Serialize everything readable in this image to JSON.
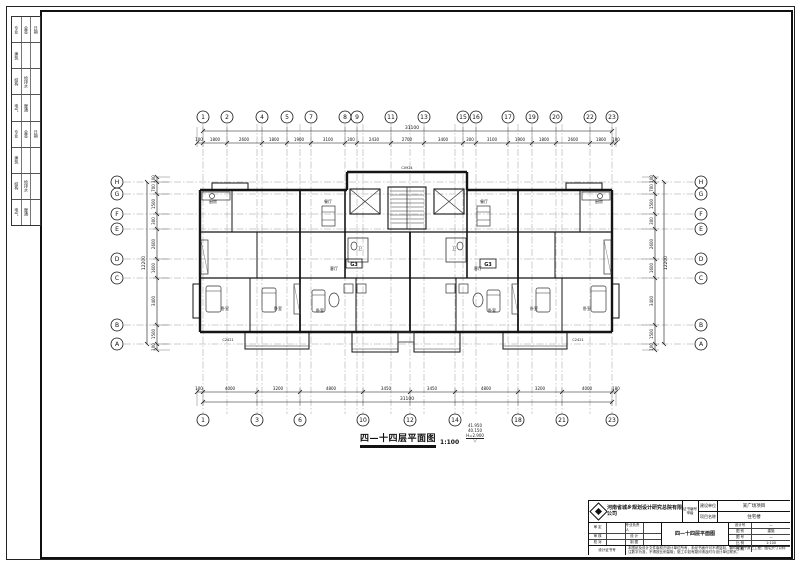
{
  "sheet": {
    "caption": "四—十四层平面图",
    "scale": "1:100",
    "elevations": [
      "41.950",
      "40.150",
      "H=2.900"
    ],
    "level_symbol": "▽"
  },
  "drawing": {
    "grid_top": {
      "y": 117,
      "items": [
        [
          "1",
          203
        ],
        [
          "2",
          227
        ],
        [
          "4",
          262
        ],
        [
          "5",
          287
        ],
        [
          "7",
          311
        ],
        [
          "8",
          345
        ],
        [
          "9",
          357
        ],
        [
          "11",
          391
        ],
        [
          "13",
          424
        ],
        [
          "15",
          463
        ],
        [
          "16",
          476
        ],
        [
          "17",
          508
        ],
        [
          "19",
          532
        ],
        [
          "20",
          556
        ],
        [
          "22",
          590
        ],
        [
          "23",
          612
        ]
      ]
    },
    "grid_bottom": {
      "y": 420,
      "items": [
        [
          "1",
          203
        ],
        [
          "3",
          257
        ],
        [
          "6",
          300
        ],
        [
          "10",
          363
        ],
        [
          "12",
          410
        ],
        [
          "14",
          455
        ],
        [
          "18",
          518
        ],
        [
          "21",
          562
        ],
        [
          "23",
          612
        ]
      ]
    },
    "grid_left": {
      "x": 117,
      "items": [
        [
          "H",
          182
        ],
        [
          "G",
          194
        ],
        [
          "F",
          214
        ],
        [
          "E",
          229
        ],
        [
          "D",
          259
        ],
        [
          "C",
          278
        ],
        [
          "B",
          325
        ],
        [
          "A",
          344
        ]
      ]
    },
    "grid_right": {
      "x": 701,
      "items": [
        [
          "H",
          182
        ],
        [
          "G",
          194
        ],
        [
          "F",
          214
        ],
        [
          "E",
          229
        ],
        [
          "D",
          259
        ],
        [
          "C",
          278
        ],
        [
          "B",
          325
        ],
        [
          "A",
          344
        ]
      ]
    },
    "dims_top": {
      "labels": [
        [
          "100",
          199
        ],
        [
          "1800",
          215
        ],
        [
          "2600",
          244
        ],
        [
          "1800",
          274
        ],
        [
          "1900",
          299
        ],
        [
          "3100",
          328
        ],
        [
          "300",
          351
        ],
        [
          "2430",
          374
        ],
        [
          "2700",
          407
        ],
        [
          "3400",
          443
        ],
        [
          "300",
          470
        ],
        [
          "3100",
          492
        ],
        [
          "1900",
          520
        ],
        [
          "1800",
          544
        ],
        [
          "2600",
          573
        ],
        [
          "1800",
          601
        ],
        [
          "100",
          616
        ]
      ],
      "overall": "31100"
    },
    "dims_bottom": {
      "labels": [
        [
          "100",
          199
        ],
        [
          "4000",
          230
        ],
        [
          "3200",
          278
        ],
        [
          "4800",
          331
        ],
        [
          "3450",
          386
        ],
        [
          "3450",
          432
        ],
        [
          "4800",
          486
        ],
        [
          "3200",
          540
        ],
        [
          "4000",
          587
        ],
        [
          "100",
          616
        ]
      ],
      "overall": "31100"
    },
    "dims_left": {
      "labels": [
        [
          "100",
          179
        ],
        [
          "700",
          188
        ],
        [
          "1500",
          204
        ],
        [
          "300",
          221
        ],
        [
          "2600",
          244
        ],
        [
          "1600",
          268
        ],
        [
          "3400",
          301
        ],
        [
          "1500",
          334
        ],
        [
          "100",
          347
        ]
      ],
      "overall": "12200"
    },
    "dims_right": {
      "labels": [
        [
          "100",
          179
        ],
        [
          "700",
          188
        ],
        [
          "1500",
          204
        ],
        [
          "300",
          221
        ],
        [
          "2600",
          244
        ],
        [
          "1600",
          268
        ],
        [
          "3400",
          301
        ],
        [
          "1500",
          334
        ],
        [
          "100",
          347
        ]
      ],
      "overall": "12200"
    },
    "unit_labels": [
      [
        "G3",
        354,
        266
      ],
      [
        "G3",
        488,
        266
      ]
    ],
    "room_labels": [
      [
        "卧室",
        225,
        310
      ],
      [
        "卧室",
        278,
        310
      ],
      [
        "卧室",
        320,
        312
      ],
      [
        "卧室",
        492,
        312
      ],
      [
        "卧室",
        534,
        310
      ],
      [
        "卧室",
        587,
        310
      ],
      [
        "客厅",
        334,
        270
      ],
      [
        "客厅",
        478,
        270
      ],
      [
        "餐厅",
        328,
        203
      ],
      [
        "餐厅",
        484,
        203
      ],
      [
        "厨房",
        213,
        203
      ],
      [
        "厨房",
        599,
        203
      ],
      [
        "卫",
        360,
        250
      ],
      [
        "卫",
        454,
        250
      ]
    ],
    "window_tags": [
      [
        "C2421",
        228,
        341
      ],
      [
        "C2421",
        578,
        341
      ],
      [
        "C0924",
        407,
        169
      ]
    ]
  },
  "signoff": {
    "rows": [
      [
        "专业",
        "会签",
        "日期"
      ],
      [
        "建筑",
        "",
        ""
      ],
      [
        "结构",
        "给排水",
        ""
      ],
      [
        "电气",
        "暖通",
        ""
      ],
      [
        "专业",
        "会签",
        "日期"
      ],
      [
        "建筑",
        "",
        ""
      ],
      [
        "结构",
        "给排水",
        ""
      ],
      [
        "电气",
        "暖通",
        ""
      ]
    ]
  },
  "titleblock": {
    "company": "河南省城乡规划设计研究总院有限公司",
    "cert_label": "证书编号",
    "cert_value": "甲级",
    "owner_label": "建设单位",
    "owner_value": "某广场项目",
    "project_label": "项目名称",
    "project_value": "住宅楼",
    "drawing_title": "四—十四层平面图",
    "grid_rows": [
      [
        "审 定",
        "",
        "专业负责人",
        ""
      ],
      [
        "审 核",
        "",
        "设 计",
        ""
      ],
      [
        "校 对",
        "",
        "制 图",
        ""
      ]
    ],
    "right_rows": [
      [
        "设计号",
        "—"
      ],
      [
        "图 别",
        "建施"
      ],
      [
        "图 号",
        "—"
      ],
      [
        "比 例",
        "1:100"
      ],
      [
        "日 期",
        "—"
      ]
    ],
    "resp_label": "设计证书号",
    "note": "本图纸及设计文件版权归设计单位所有，未经书面许可不得复制、翻印或用于其它工程；图中尺寸以标注数字为准，不得按比例量取；施工中如有疑问请及时与设计单位联系。"
  }
}
